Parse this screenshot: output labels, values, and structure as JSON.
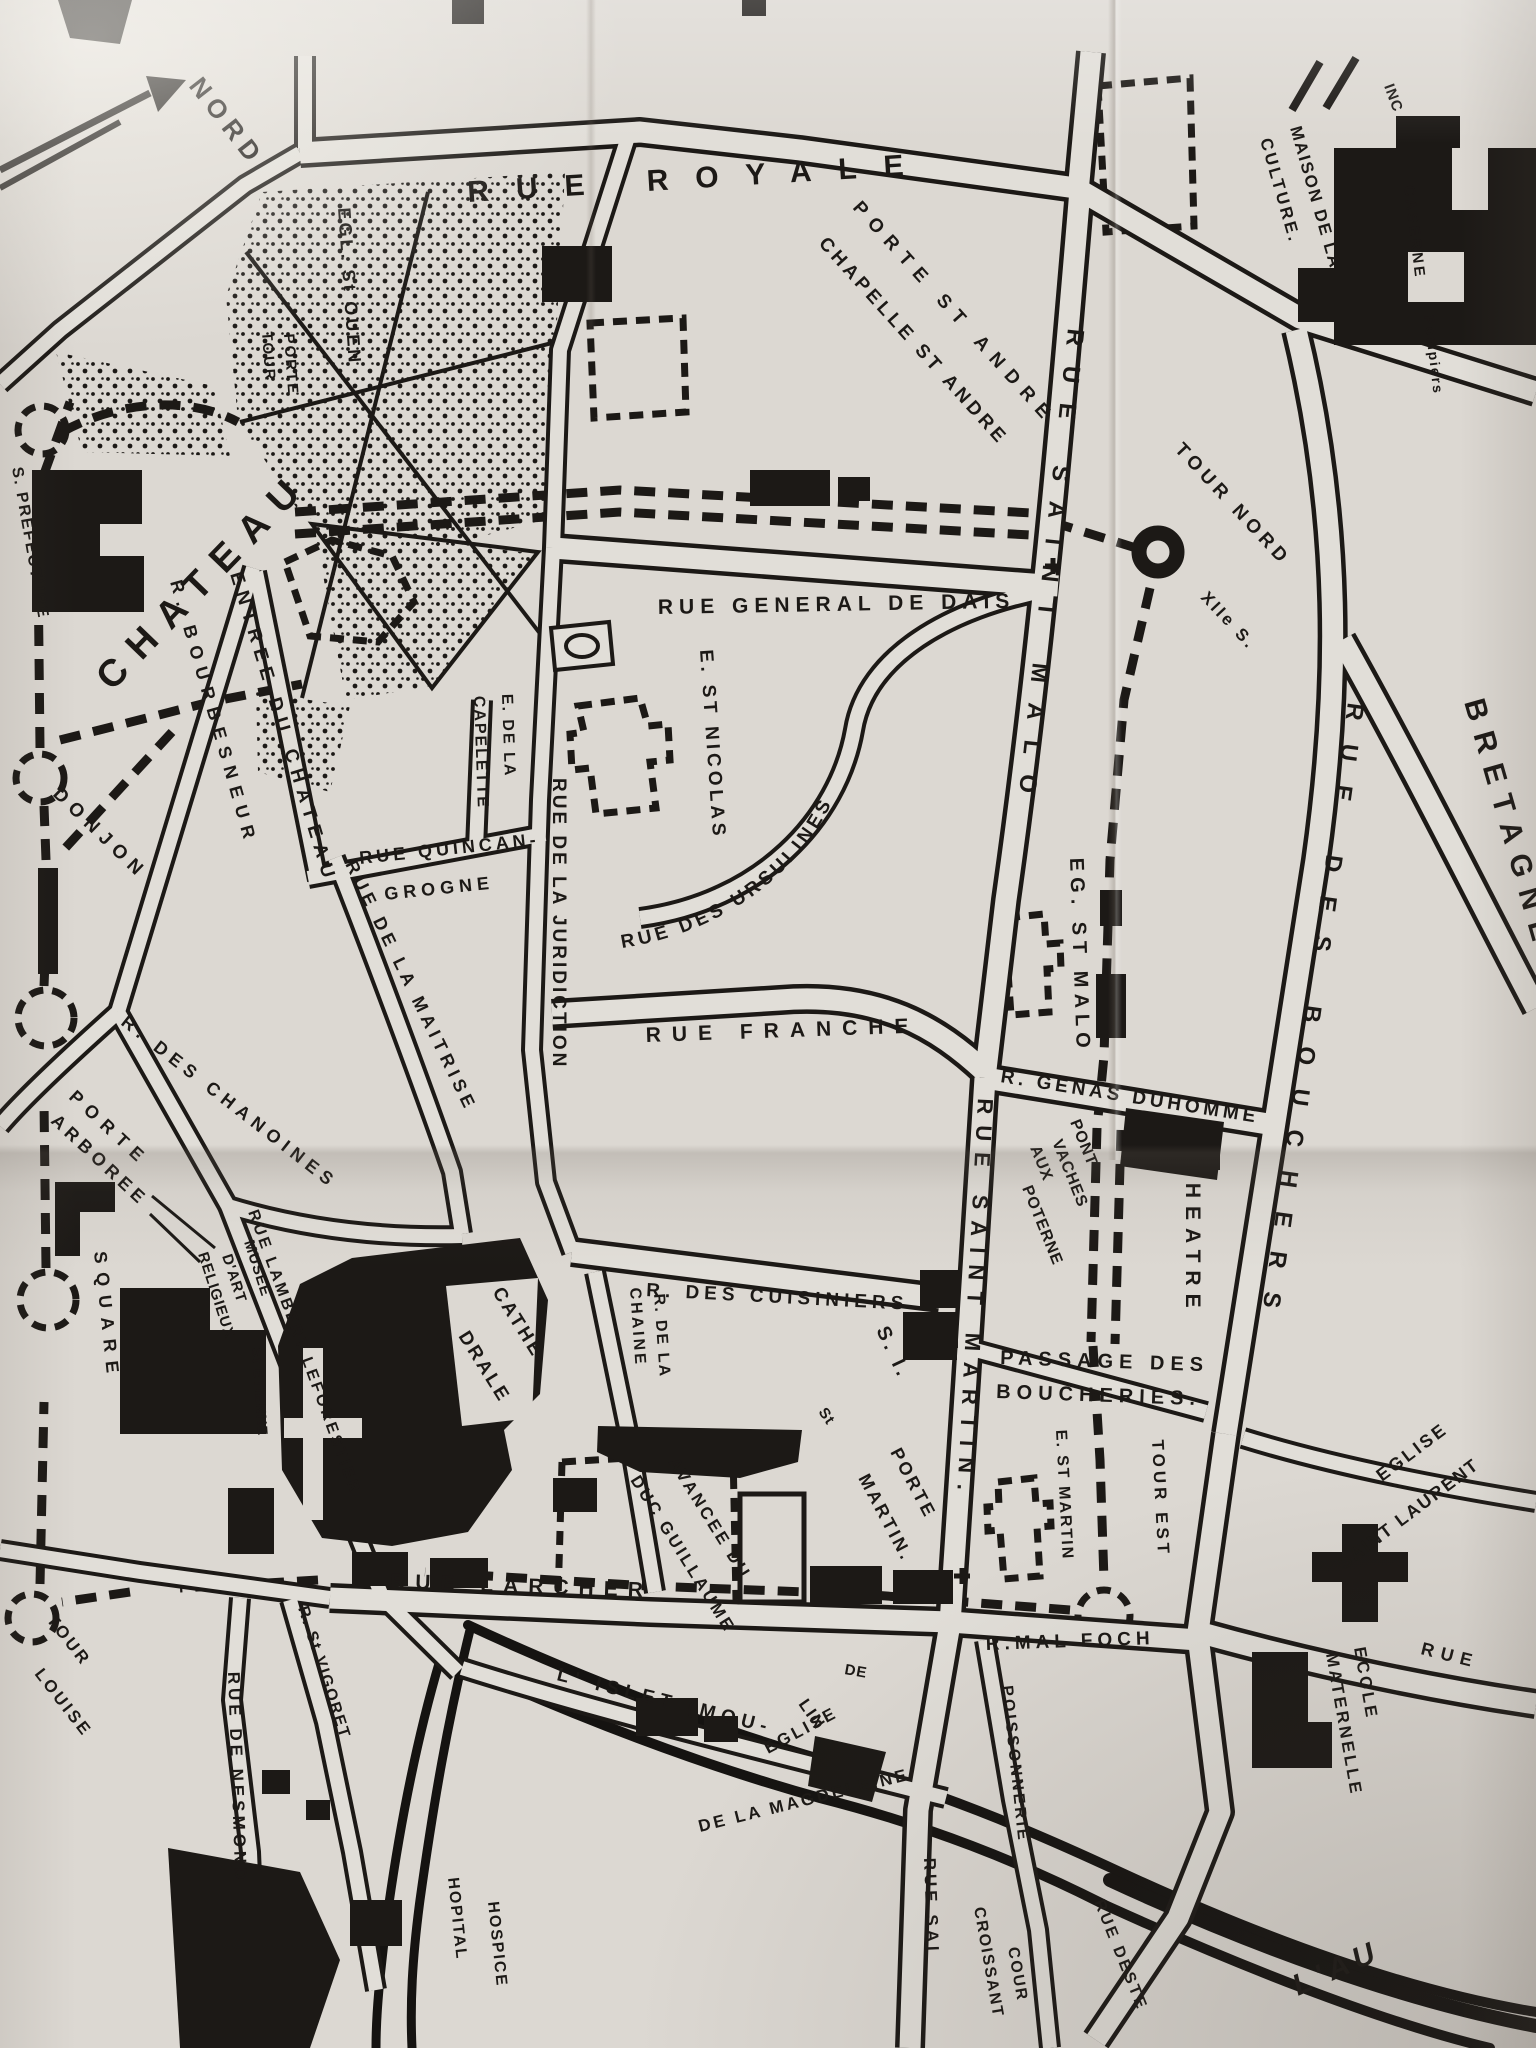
{
  "map": {
    "type": "hand-drawn town plan (photograph of paper map)",
    "colors": {
      "paper": "#dcd8d2",
      "ink": "#1c1916",
      "road_fill": "#e1ded8"
    },
    "compass": {
      "north_label": "NORD"
    },
    "labels": {
      "nord": "NORD",
      "rue_royale": "RUE ROYALE",
      "porte_st_andre": "PORTE ST ANDRE",
      "chapelle_st_andre": "CHAPELLE ST ANDRE",
      "maison_de_la": "MAISON DE LA",
      "culture": "CULTURE.",
      "inc": "INC",
      "caserne": "CASERNE",
      "pompiers": "Pompiers",
      "egl_st_ouen": "EGL. St OUEN",
      "tour_col": "TOUR",
      "porte_col": "PORTE",
      "chateau": "CHATEAU",
      "s_prefecture": "S. PREFECTURE",
      "donjon": "DONJON",
      "r_bourbesneur": "R. BOURBESNEUR",
      "entree_du_chateau": "ENTREE DU CHATEAU",
      "rue_quincan": "RUE QUINCAN-",
      "grogne": "GROGNE",
      "rue_de_la_maitrise": "RUE DE LA MAITRISE",
      "rue_de_la_juridiction": "RUE DE LA JURIDICTION",
      "e_de_la": "E. DE LA",
      "capelette": "CAPELETTE",
      "rue_general_de_dais": "RUE GENERAL DE DAIS",
      "e_st_nicolas": "E. ST NICOLAS",
      "rue_des_ursulines": "RUE DES URSULINES",
      "rue_franche": "RUE FRANCHE",
      "eg_st_malo": "EG. ST MALO",
      "r_genas_duhomme": "R. GENAS DUHOMME",
      "rue_saint_malo": "RUE SAINT MALO",
      "tour_nord": "TOUR NORD",
      "xii_s": "XIIe S.",
      "rue_des_bouchers": "RUE DES BOUCHERS",
      "bretagne": "BRETAGNE",
      "pont": "PONT",
      "aux": "AUX",
      "vaches": "VACHES",
      "poterne": "POTERNE",
      "theatre": "THEATRE",
      "rue_saint_martin": "RUE SAINT MARTIN.",
      "passage_des": "PASSAGE DES",
      "boucheries": "BOUCHERIES.",
      "r_des_cuisiniers": "R. DES CUISINIERS",
      "s_i": "S. I.",
      "st_abbrev": "St",
      "porte_martin_porte": "PORTE",
      "porte_martin_martin": "MARTIN.",
      "r_de_la": "R. DE LA",
      "chaine": "CHAINE",
      "avancee_du": "AVANCEE DU",
      "duc_guillaume": "DUC GUILLAUME",
      "e_st_martin": "E. ST MARTIN",
      "tour_est": "TOUR EST",
      "eglise_laurent": "EGLISE",
      "saint_laurent": "SAINT LAURENT",
      "ecole": "ECOLE",
      "maternelle": "MATERNELLE",
      "rue_east": "RUE",
      "rue_larcher": "RUE LARCHER",
      "r_mal_foch": "R.MAL FOCH",
      "tour_louise_tour": "TOUR",
      "tour_louise_louise": "LOUISE",
      "r_st_vigoret": "R. St VIGORET",
      "rue_de_nesmond": "RUE DE NESMOND",
      "islet": "L' ISLET (MOU-",
      "lin": "LIN",
      "de": "DE",
      "eglise_magdeleine": "EGLISE",
      "de_la_magdeleine": "DE LA MAGDELEINE",
      "poissonnerie": "POISSONNERIE",
      "cour": "COUR",
      "croissant": "CROISSANT",
      "rue_deste": "RUE DESTE",
      "rue_sai": "RUE SAI",
      "hopital": "HOPITAL",
      "hospice": "HOSPICE",
      "l_au": "L'AU",
      "porte_arboree_porte": "PORTE",
      "arboree": "ARBOREE",
      "r_des_chanoines": "R. DES CHANOINES",
      "square": "SQUARE",
      "musee": "MUSEE",
      "d_art": "D'ART",
      "religieux": "RELIGIEUX",
      "rue_lambert": "RUE LAMBERT LEFORESTIER",
      "st_etienne": "St ETIENNE",
      "cathe": "CATHE-",
      "drale": "DRALE"
    }
  }
}
